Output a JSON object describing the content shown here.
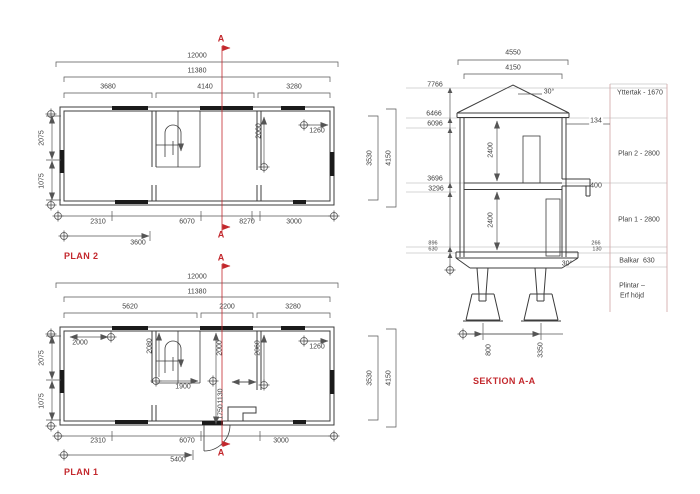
{
  "drawing": {
    "marker_letter": "A",
    "plan2": {
      "title": "PLAN 2",
      "dims": {
        "total": "12000",
        "inner": "11380",
        "segments": [
          "3680",
          "4140",
          "3280"
        ],
        "left": [
          "2075",
          "1075"
        ],
        "right": [
          "3530",
          "4150"
        ],
        "interior": [
          "2060",
          "1260"
        ],
        "bottom": [
          "2310",
          "6070",
          "8270",
          "3000"
        ],
        "bottom_offset": "3600"
      }
    },
    "plan1": {
      "title": "PLAN 1",
      "dims": {
        "total": "12000",
        "inner": "11380",
        "segments": [
          "5620",
          "2200",
          "3280"
        ],
        "left": [
          "2075",
          "1075"
        ],
        "right": [
          "3530",
          "4150"
        ],
        "interior": [
          "2000",
          "2080",
          "2000",
          "1130",
          "1750",
          "1900",
          "2060",
          "1260"
        ],
        "bottom": [
          "2310",
          "6070",
          "3000"
        ],
        "bottom_offset": "5400"
      }
    },
    "section": {
      "title": "SEKTION A-A",
      "width_dims": [
        "4550",
        "4150"
      ],
      "roof_angle": "30°",
      "base_angle": "30°",
      "levels": [
        "7766",
        "6466",
        "6096",
        "3696",
        "3296",
        "896",
        "630"
      ],
      "room_heights": [
        "2400",
        "2400"
      ],
      "side_dims": [
        "134",
        "400",
        "266",
        "130"
      ],
      "footing_dims": [
        "800",
        "3350"
      ],
      "legend": [
        "Yttertak - 1670",
        "Plan 2 - 2800",
        "Plan 1 - 2800",
        "Balkar  630",
        "Plintar –",
        "Erf höjd"
      ]
    },
    "colors": {
      "line": "#3c3c3c",
      "dim": "#555555",
      "red": "#c3282d",
      "light": "#c8c8c8"
    }
  }
}
